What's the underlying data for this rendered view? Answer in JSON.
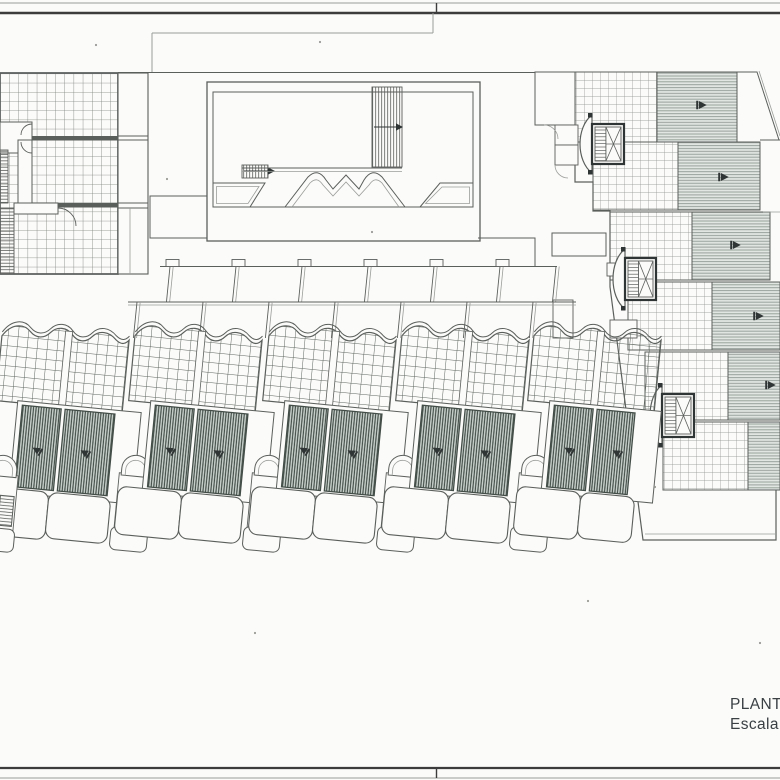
{
  "document": {
    "kind": "scanned architectural site / roof plan",
    "annotation_line1": "PLANT",
    "annotation_line2": "Escala"
  },
  "colors": {
    "paper": "#fbfbf9",
    "ink": "#2f3434",
    "text": "#3a4044",
    "line-mid": "#5b5f5c",
    "line-soft": "#9a9d99",
    "grid-big": "#7c817c",
    "grid-fine": "#8a8f8a",
    "grid-house": "#5f665f",
    "stripe-bg": "#e2e6e3",
    "stripe-line": "#98a19b",
    "panel-bg": "#cdd5d0",
    "panel-line": "#434d47",
    "frame-dark": "#3c3c3c",
    "frame-light": "#b9b9b5"
  },
  "frame": {
    "top_light_y": 3,
    "top_dark_y": 13,
    "bottom_dark_y": 768,
    "bottom_light_y": 778,
    "tick_x": 436.5
  },
  "cascade": {
    "units": [
      {
        "gx": 575,
        "gy": 72,
        "gw": 82,
        "gh": 70,
        "sx": 657,
        "sw": 80,
        "ax": 700,
        "ay": 105
      },
      {
        "gx": 593,
        "gy": 142,
        "gw": 85,
        "gh": 68,
        "sx": 678,
        "sw": 82,
        "ax": 722,
        "ay": 177
      },
      {
        "gx": 610,
        "gy": 212,
        "gw": 82,
        "gh": 68,
        "sx": 692,
        "sw": 78,
        "ax": 734,
        "ay": 245
      },
      {
        "gx": 628,
        "gy": 282,
        "gw": 84,
        "gh": 68,
        "sx": 712,
        "sw": 68,
        "ax": 757,
        "ay": 316
      },
      {
        "gx": 645,
        "gy": 352,
        "gw": 83,
        "gh": 68,
        "sx": 728,
        "sw": 52,
        "ax": 769,
        "ay": 385
      },
      {
        "gx": 663,
        "gy": 422,
        "gw": 85,
        "gh": 68,
        "sx": 748,
        "sw": 32,
        "ax": null,
        "ay": null
      }
    ],
    "cores": [
      {
        "x": 592,
        "y": 124,
        "w": 32,
        "h": 40
      },
      {
        "x": 625,
        "y": 258,
        "w": 31,
        "h": 42
      },
      {
        "x": 662,
        "y": 394,
        "w": 32,
        "h": 43
      }
    ]
  },
  "row_houses": {
    "angle_deg": 5.5,
    "pivot": [
      66,
      525
    ],
    "full_units": [
      {
        "ox": -20,
        "stair": true,
        "p2w": 50,
        "r2w": 62
      },
      {
        "ox": 113,
        "stair": true,
        "p2w": 50,
        "r2w": 62
      },
      {
        "ox": 247,
        "stair": true,
        "p2w": 50,
        "r2w": 62
      },
      {
        "ox": 380,
        "stair": true,
        "p2w": 50,
        "r2w": 62
      },
      {
        "ox": 512,
        "stair": false,
        "p2w": 38,
        "r2w": 54
      }
    ],
    "extra_stairs": [
      -153
    ],
    "arrow_local": [
      [
        51,
        452
      ],
      [
        99,
        450
      ]
    ],
    "quad_row1": {
      "top_y": 266.5,
      "bot_y": 302,
      "x0": 160,
      "x1": 557,
      "div_top_x": [
        170,
        236,
        302,
        368,
        434,
        500,
        556
      ]
    },
    "quad_row2": {
      "top_y": 302,
      "bot_y": 338,
      "x0": 128,
      "x1": 576,
      "div_top_x": [
        137,
        203,
        269,
        335,
        401,
        467,
        533
      ]
    },
    "tabs_x": [
      166,
      232,
      298,
      364,
      430,
      496
    ],
    "tab_w": 13
  },
  "courtyard": {
    "outer": [
      207,
      82,
      273,
      159
    ],
    "inner": [
      213,
      92,
      260,
      115
    ],
    "ramp_band": [
      372,
      87,
      30,
      80
    ],
    "small_stair": [
      242,
      165,
      26,
      13
    ]
  },
  "specks": [
    [
      320,
      42
    ],
    [
      655,
      487
    ],
    [
      167,
      179
    ],
    [
      372,
      232
    ],
    [
      96,
      45
    ],
    [
      588,
      601
    ],
    [
      255,
      633
    ],
    [
      760,
      643
    ]
  ]
}
